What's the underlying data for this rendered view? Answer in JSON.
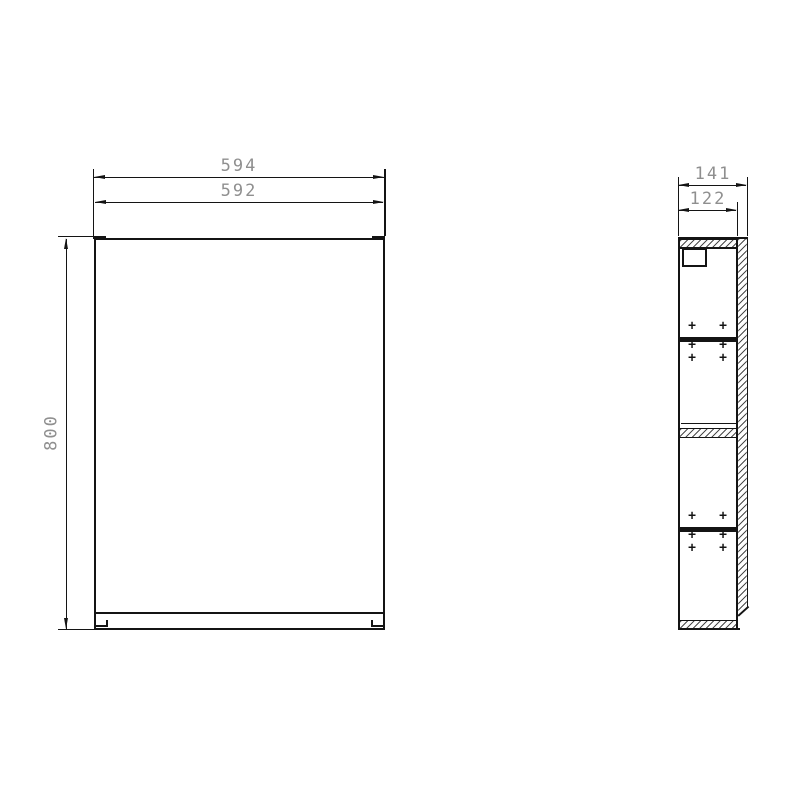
{
  "drawing": {
    "type": "technical-drawing",
    "views": {
      "front": {
        "dim_width_outer": "594",
        "dim_width_inner": "592",
        "dim_height": "800"
      },
      "side": {
        "dim_depth_outer": "141",
        "dim_depth_inner": "122",
        "screw_marker": "+"
      }
    },
    "colors": {
      "line": "#141414",
      "dim_text": "#8f8f8f",
      "hatch_line": "#2d2d2d",
      "background": "#ffffff"
    }
  }
}
